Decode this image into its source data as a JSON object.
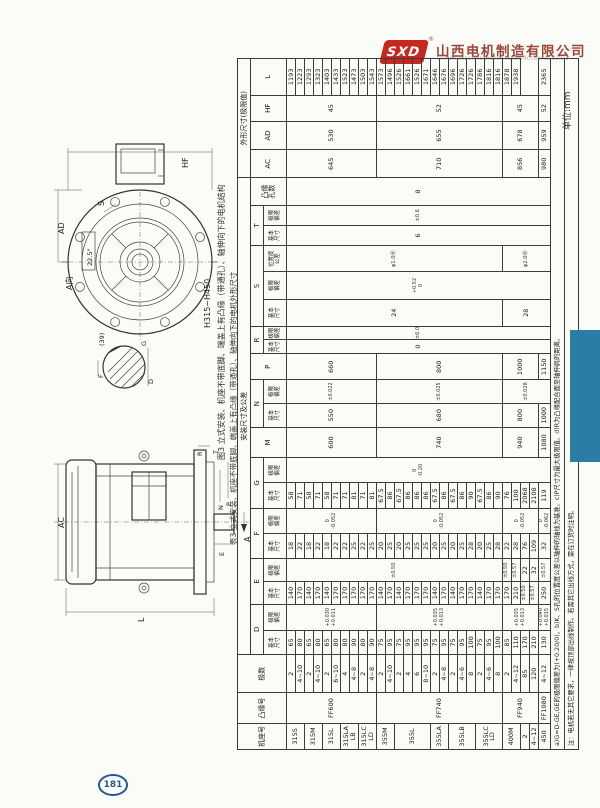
{
  "page": {
    "unit_label": "单位:mm",
    "page_number": "181"
  },
  "logo": {
    "mark": "SXD",
    "reg": "®",
    "company": "山西电机制造有限公司",
    "tagline": "SHANXI ELECTRIC MOTOR MANUFACTURING Co.Ltd"
  },
  "captions": {
    "figure": "图3 立式安装、机座不带底脚、端盖上有凸缘（带通孔）、轴伸向下的电机结构",
    "table": "表3 立式安装、机座不带底脚、端盖上有凸缘（带通孔）、轴伸向下的电机外形尺寸"
  },
  "drawings": {
    "flange_view": {
      "hf": "HF",
      "ad": "AD",
      "view": "A向",
      "angle": "22.5°",
      "s": "S",
      "range": "H315~H450"
    },
    "key_section": {
      "note": "(39)",
      "g": "G",
      "f": "F",
      "d": "D"
    },
    "side_view": {
      "ac": "AC",
      "l": "L",
      "r": "R",
      "t": "T",
      "n": "N",
      "p": "P",
      "e": "E",
      "a": "A"
    }
  },
  "table": {
    "col_widths": [
      26,
      30,
      38,
      24,
      26,
      22,
      23,
      25,
      25,
      25,
      25,
      30,
      24,
      23,
      26,
      14,
      13,
      27,
      27,
      26,
      20,
      20,
      27,
      28,
      28,
      26,
      36
    ],
    "head": [
      [
        {
          "t": "机座号",
          "rs": 3
        },
        {
          "t": "凸缘号",
          "rs": 3
        },
        {
          "t": "极数",
          "rs": 3
        },
        {
          "t": "安装尺寸及公差",
          "cs": 20
        },
        {
          "t": "外形尺寸(极限值)",
          "cs": 4
        }
      ],
      [
        {
          "t": "D",
          "cs": 2
        },
        {
          "t": "E",
          "cs": 2
        },
        {
          "t": "F",
          "cs": 2
        },
        {
          "t": "G",
          "cs": 2
        },
        {
          "t": "M",
          "rs": 2
        },
        {
          "t": "N",
          "cs": 2
        },
        {
          "t": "P",
          "rs": 2
        },
        {
          "t": "R",
          "cs": 2
        },
        {
          "t": "S",
          "cs": 3
        },
        {
          "t": "T",
          "cs": 2
        },
        {
          "t": "凸缘\n孔数",
          "rs": 2
        },
        {
          "t": "AC",
          "rs": 2
        },
        {
          "t": "AD",
          "rs": 2
        },
        {
          "t": "HF",
          "rs": 2
        },
        {
          "t": "L",
          "rs": 2
        }
      ],
      [
        {
          "t": "基本\n尺寸"
        },
        {
          "t": "极限\n偏差"
        },
        {
          "t": "基本\n尺寸"
        },
        {
          "t": "极限\n偏差"
        },
        {
          "t": "基本\n尺寸"
        },
        {
          "t": "极限\n偏差"
        },
        {
          "t": "基本\n尺寸"
        },
        {
          "t": "极限\n偏差"
        },
        {
          "t": "基本\n尺寸"
        },
        {
          "t": "极限\n偏差"
        },
        {
          "t": "基本\n尺寸"
        },
        {
          "t": "极限\n偏差"
        },
        {
          "t": "基本\n尺寸"
        },
        {
          "t": "极限\n偏差"
        },
        {
          "t": "位置度\n公差"
        },
        {
          "t": "基本\n尺寸"
        },
        {
          "t": "极限\n偏差"
        }
      ]
    ],
    "body": [
      [
        {
          "t": "315S",
          "rs": 2,
          "c": "lbl"
        },
        {
          "t": "FF600",
          "rs": 10,
          "c": "lbl"
        },
        {
          "t": "2"
        },
        {
          "t": "65"
        },
        {
          "t": "+0.030\n+0.011",
          "rs": 10,
          "c": "tol"
        },
        {
          "t": "140"
        },
        {
          "t": "±0.50",
          "rs": 24,
          "c": "tol"
        },
        {
          "t": "18"
        },
        {
          "t": "0\n-0.052",
          "rs": 10,
          "c": "tol"
        },
        {
          "t": "58"
        },
        {
          "t": "0\n-0.20",
          "rs": 29,
          "c": "tol"
        },
        {
          "t": "600",
          "rs": 10
        },
        {
          "t": "550",
          "rs": 10
        },
        {
          "t": "±0.022",
          "rs": 10,
          "c": "tol"
        },
        {
          "t": "660",
          "rs": 10
        },
        {
          "t": "0",
          "rs": 29
        },
        {
          "t": "±6.0",
          "rs": 29,
          "c": "tol"
        },
        {
          "t": "24",
          "rs": 24
        },
        {
          "t": "+0.52\n0",
          "rs": 29,
          "c": "tol"
        },
        {
          "t": "φ1.0Ⓜ",
          "rs": 24,
          "c": "tol"
        },
        {
          "t": "6",
          "rs": 29
        },
        {
          "t": "±0.6",
          "rs": 29,
          "c": "tol"
        },
        {
          "t": "8",
          "rs": 29
        },
        {
          "t": "645",
          "rs": 10
        },
        {
          "t": "530",
          "rs": 10
        },
        {
          "t": "45",
          "rs": 10
        },
        {
          "t": "1193"
        }
      ],
      [
        {
          "t": "4~10"
        },
        {
          "t": "80"
        },
        {
          "t": "170"
        },
        {
          "t": "22"
        },
        {
          "t": "71"
        },
        {
          "t": "1223"
        }
      ],
      [
        {
          "t": "315M",
          "rs": 2,
          "c": "lbl"
        },
        {
          "t": "2"
        },
        {
          "t": "65"
        },
        {
          "t": "140"
        },
        {
          "t": "18"
        },
        {
          "t": "58"
        },
        {
          "t": "1293"
        }
      ],
      [
        {
          "t": "4~10"
        },
        {
          "t": "80"
        },
        {
          "t": "170"
        },
        {
          "t": "22"
        },
        {
          "t": "71"
        },
        {
          "t": "1323"
        }
      ],
      [
        {
          "t": "315L",
          "rs": 2,
          "c": "lbl"
        },
        {
          "t": "2"
        },
        {
          "t": "65"
        },
        {
          "t": "140"
        },
        {
          "t": "18"
        },
        {
          "t": "58"
        },
        {
          "t": "1403"
        }
      ],
      [
        {
          "t": "6~10"
        },
        {
          "t": "80"
        },
        {
          "t": "170"
        },
        {
          "t": "22"
        },
        {
          "t": "71"
        },
        {
          "t": "1433"
        }
      ],
      [
        {
          "t": "315LA\nLB",
          "rs": 2,
          "c": "lbl"
        },
        {
          "t": "4"
        },
        {
          "t": "80"
        },
        {
          "t": "170"
        },
        {
          "t": "22"
        },
        {
          "t": "71"
        },
        {
          "t": "1523"
        }
      ],
      [
        {
          "t": "4~8"
        },
        {
          "t": "90"
        },
        {
          "t": "170"
        },
        {
          "t": "25"
        },
        {
          "t": "81"
        },
        {
          "t": "1473"
        }
      ],
      [
        {
          "t": "315LC\nLD",
          "rs": 2,
          "c": "lbl"
        },
        {
          "t": "2"
        },
        {
          "t": "80"
        },
        {
          "t": "170"
        },
        {
          "t": "22"
        },
        {
          "t": "71"
        },
        {
          "t": "1503"
        }
      ],
      [
        {
          "t": "4~8"
        },
        {
          "t": "90"
        },
        {
          "t": "170"
        },
        {
          "t": "25"
        },
        {
          "t": "81"
        },
        {
          "t": "1543"
        }
      ],
      [
        {
          "t": "355M",
          "rs": 2,
          "c": "lbl"
        },
        {
          "t": "FF740",
          "rs": 14,
          "c": "lbl"
        },
        {
          "t": "2"
        },
        {
          "t": "75"
        },
        {
          "t": "+0.035\n+0.013",
          "rs": 14,
          "c": "tol"
        },
        {
          "t": "140"
        },
        {
          "t": "20"
        },
        {
          "t": "0\n-0.052",
          "rs": 14,
          "c": "tol"
        },
        {
          "t": "67.5"
        },
        {
          "t": "740",
          "rs": 14
        },
        {
          "t": "680",
          "rs": 14
        },
        {
          "t": "±0.025",
          "rs": 14,
          "c": "tol"
        },
        {
          "t": "800",
          "rs": 14
        },
        {
          "t": "710",
          "rs": 14
        },
        {
          "t": "655",
          "rs": 14
        },
        {
          "t": "52",
          "rs": 14
        },
        {
          "t": "1573"
        }
      ],
      [
        {
          "t": "4~10"
        },
        {
          "t": "95"
        },
        {
          "t": "170"
        },
        {
          "t": "25"
        },
        {
          "t": "86"
        },
        {
          "t": "1496"
        }
      ],
      [
        {
          "t": "355L",
          "rs": 4,
          "c": "lbl"
        },
        {
          "t": "2"
        },
        {
          "t": "75"
        },
        {
          "t": "140"
        },
        {
          "t": "20"
        },
        {
          "t": "67.5"
        },
        {
          "t": "1526"
        }
      ],
      [
        {
          "t": "4"
        },
        {
          "t": "95"
        },
        {
          "t": "170"
        },
        {
          "t": "25"
        },
        {
          "t": "86"
        },
        {
          "t": "1661"
        }
      ],
      [
        {
          "t": "6"
        },
        {
          "t": "95"
        },
        {
          "t": "170"
        },
        {
          "t": "25"
        },
        {
          "t": "86"
        },
        {
          "t": "1526"
        }
      ],
      [
        {
          "t": "8~10"
        },
        {
          "t": "95"
        },
        {
          "t": "170"
        },
        {
          "t": "25"
        },
        {
          "t": "86"
        },
        {
          "t": "1671"
        }
      ],
      [
        {
          "t": "355LA",
          "rs": 2,
          "c": "lbl"
        },
        {
          "t": "2"
        },
        {
          "t": "75"
        },
        {
          "t": "140"
        },
        {
          "t": "20"
        },
        {
          "t": "67.5"
        },
        {
          "t": "1646"
        }
      ],
      [
        {
          "t": "4~8"
        },
        {
          "t": "95"
        },
        {
          "t": "170"
        },
        {
          "t": "25"
        },
        {
          "t": "86"
        },
        {
          "t": "1676"
        }
      ],
      [
        {
          "t": "355LB",
          "rs": 3,
          "c": "lbl"
        },
        {
          "t": "2"
        },
        {
          "t": "75"
        },
        {
          "t": "140"
        },
        {
          "t": "20"
        },
        {
          "t": "67.5"
        },
        {
          "t": "1696"
        }
      ],
      [
        {
          "t": "4~6"
        },
        {
          "t": "95"
        },
        {
          "t": "170"
        },
        {
          "t": "25"
        },
        {
          "t": "86"
        },
        {
          "t": "1726"
        }
      ],
      [
        {
          "t": "8"
        },
        {
          "t": "100"
        },
        {
          "t": "170"
        },
        {
          "t": "28"
        },
        {
          "t": "90"
        },
        {
          "t": "1726"
        }
      ],
      [
        {
          "t": "355LC\nLD",
          "rs": 3,
          "c": "lbl"
        },
        {
          "t": "2"
        },
        {
          "t": "75"
        },
        {
          "t": "140"
        },
        {
          "t": "20"
        },
        {
          "t": "67.5"
        },
        {
          "t": "1786"
        }
      ],
      [
        {
          "t": "4~6"
        },
        {
          "t": "95"
        },
        {
          "t": "170"
        },
        {
          "t": "25"
        },
        {
          "t": "86"
        },
        {
          "t": "1816"
        }
      ],
      [
        {
          "t": "8"
        },
        {
          "t": "100"
        },
        {
          "t": "170"
        },
        {
          "t": "28"
        },
        {
          "t": "90"
        },
        {
          "t": "1816"
        }
      ],
      [
        {
          "t": "400M",
          "rs": 2,
          "c": "lbl"
        },
        {
          "t": "FF940",
          "rs": 4,
          "c": "lbl"
        },
        {
          "t": "2"
        },
        {
          "t": "85"
        },
        {
          "t": "+0.035\n+0.013",
          "rs": 4,
          "c": "tol"
        },
        {
          "t": "170"
        },
        {
          "t": "±0.50",
          "c": "tol"
        },
        {
          "t": "22"
        },
        {
          "t": "0\n-0.052",
          "rs": 4,
          "c": "tol"
        },
        {
          "t": "76"
        },
        {
          "t": "940",
          "rs": 4
        },
        {
          "t": "800",
          "rs": 4
        },
        {
          "t": "±0.028",
          "rs": 5,
          "c": "tol"
        },
        {
          "t": "1000",
          "rs": 4
        },
        {
          "t": "28",
          "rs": 5
        },
        {
          "t": "φ2.0Ⓜ",
          "rs": 5,
          "c": "tol"
        },
        {
          "t": "856",
          "rs": 4
        },
        {
          "t": "678",
          "rs": 4
        },
        {
          "t": "45",
          "rs": 4
        },
        {
          "t": "1878"
        }
      ],
      [
        {
          "t": "4~12"
        },
        {
          "t": "110"
        },
        {
          "t": "210"
        },
        {
          "t": "±0.57",
          "c": "tol"
        },
        {
          "t": "28"
        },
        {
          "t": "100"
        },
        {
          "t": "1938"
        }
      ],
      [
        {
          "t": "2"
        },
        {
          "t": "85"
        },
        {
          "t": "170"
        },
        {
          "t": "±0.50",
          "c": "tol"
        },
        {
          "t": "22"
        },
        {
          "t": "76"
        },
        {
          "t": "2068"
        }
      ],
      [
        {
          "t": "4~12"
        },
        {
          "t": "120"
        },
        {
          "t": "210"
        },
        {
          "t": "±0.57",
          "c": "tol"
        },
        {
          "t": "32"
        },
        {
          "t": "109"
        },
        {
          "t": "2108"
        }
      ],
      [
        {
          "t": "450",
          "c": "lbl"
        },
        {
          "t": "FF1080",
          "c": "lbl"
        },
        {
          "t": "4~12"
        },
        {
          "t": "130"
        },
        {
          "t": "+0.040\n+0.015",
          "c": "tol"
        },
        {
          "t": "250"
        },
        {
          "t": "±0.57",
          "c": "tol"
        },
        {
          "t": "32"
        },
        {
          "t": "0\n-0.062",
          "c": "tol"
        },
        {
          "t": "119"
        },
        {
          "t": "1080"
        },
        {
          "t": "1000"
        },
        {
          "t": "1150"
        },
        {
          "t": "980"
        },
        {
          "t": "959"
        },
        {
          "t": "52"
        },
        {
          "t": "2365"
        }
      ]
    ],
    "notes": [
      "a)G=D-GE,GE的极限偏差为(+0.20/0)。b)K、S孔的位置度公差以轴伸的轴线为基准。c)P尺寸为最大极限值。d)R为凸缘配合面至轴伸肩的距离。",
      "注：电机若无其它要求，一律按顶部出线制作。若需其它出线方式，需在订货时注明。"
    ]
  }
}
